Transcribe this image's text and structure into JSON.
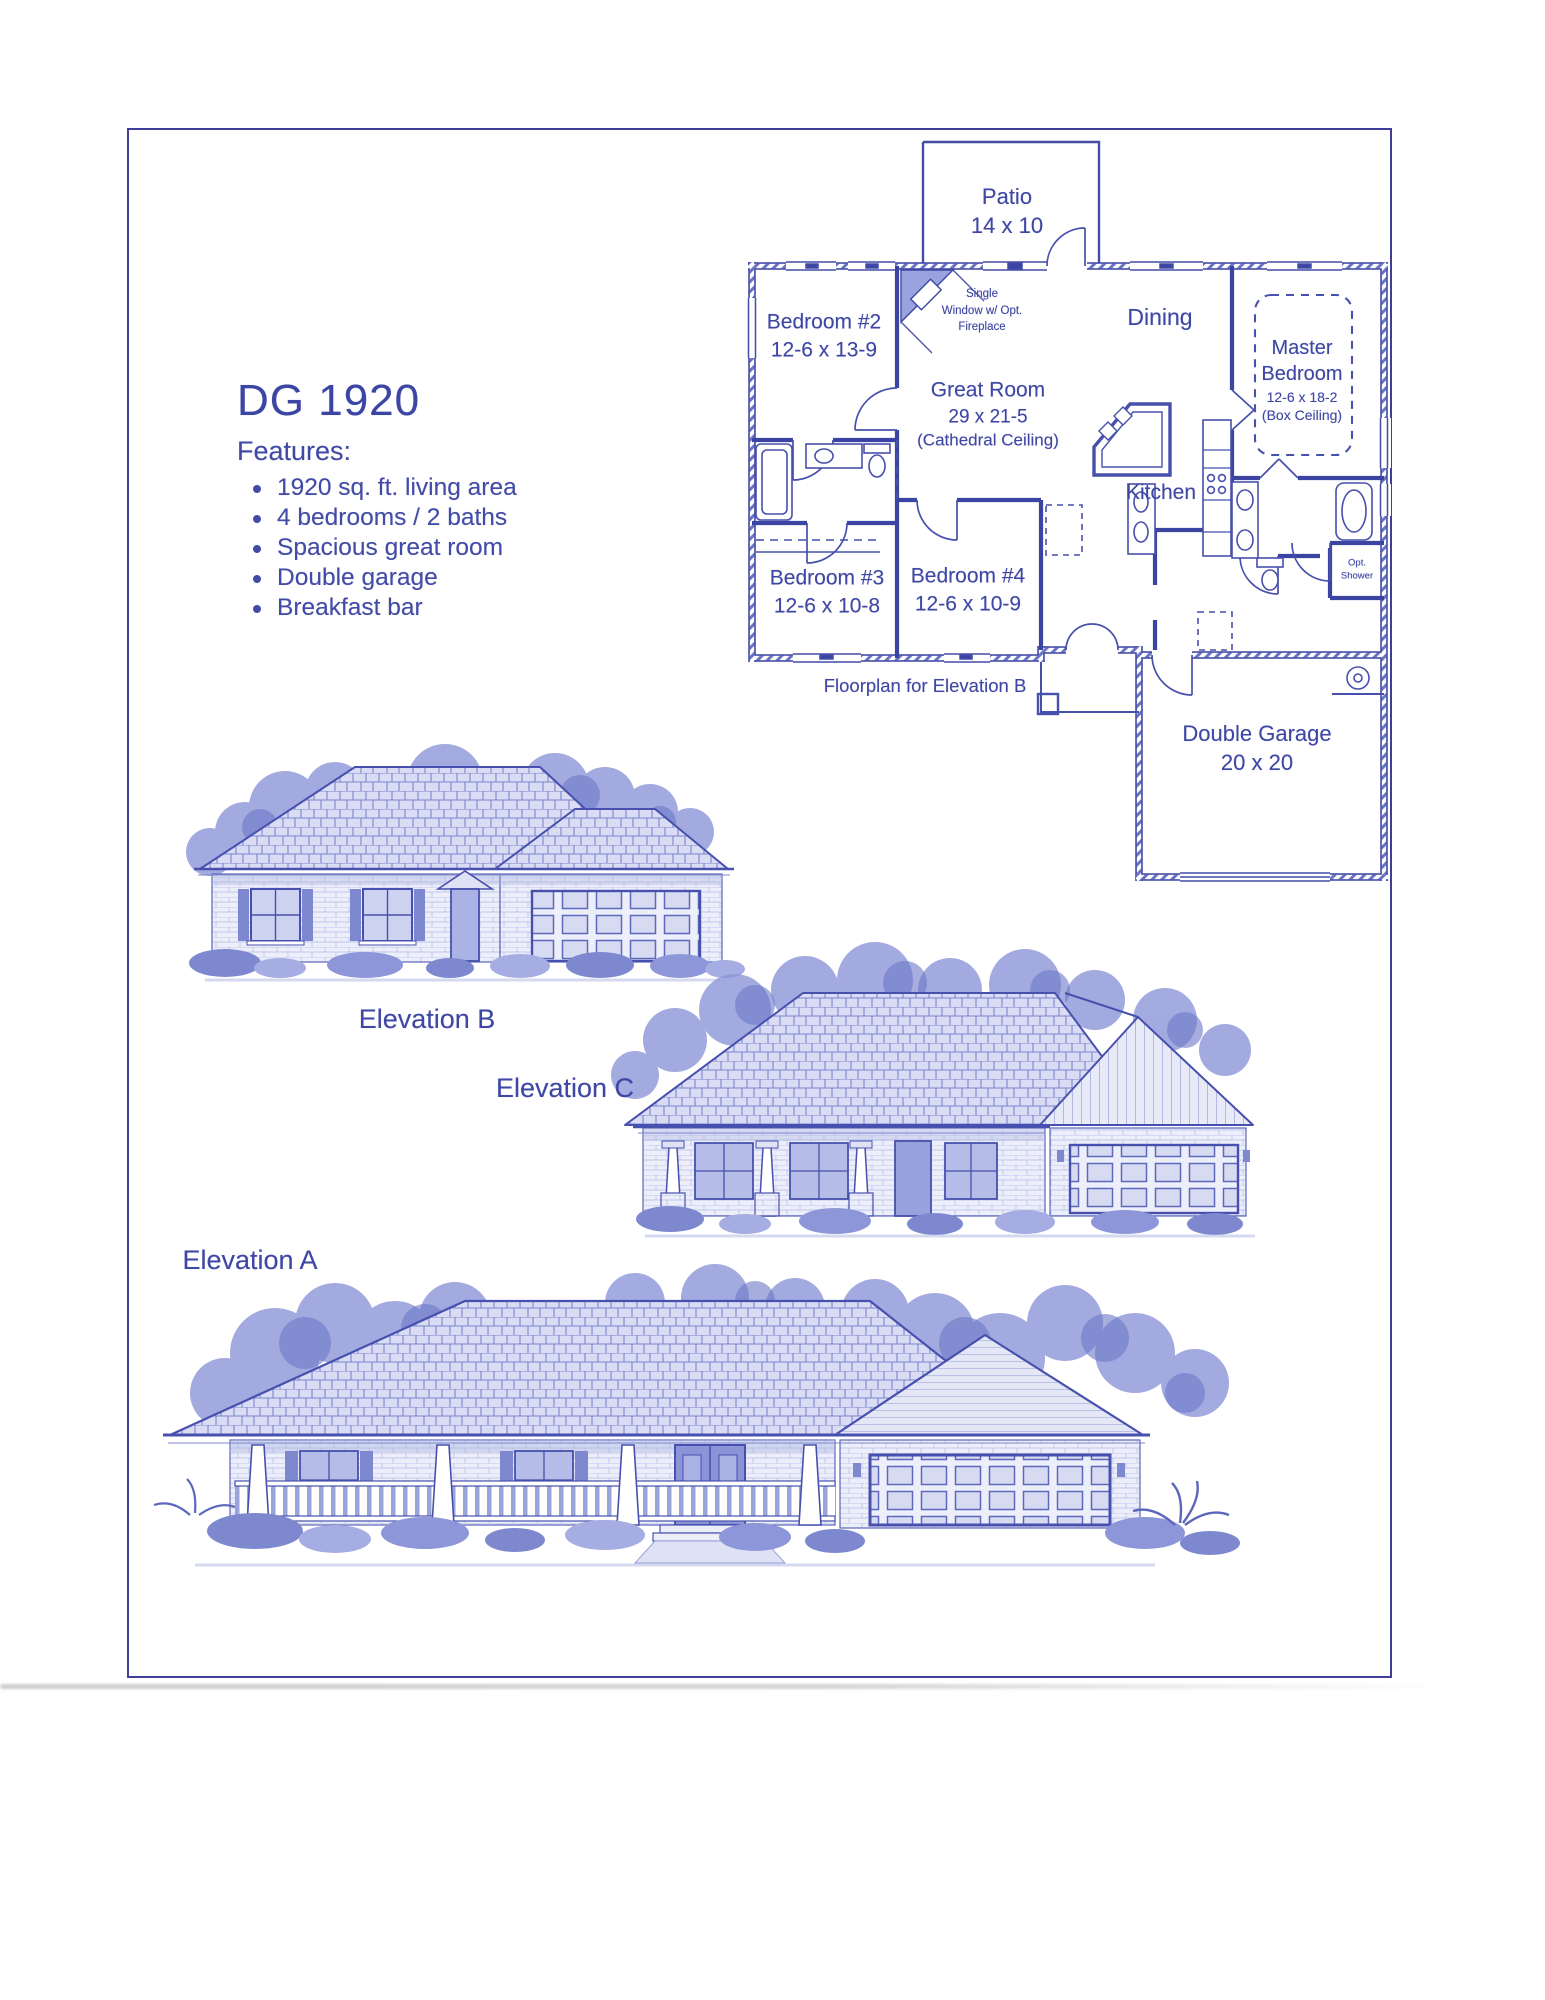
{
  "document": {
    "plan_id": "DG 1920",
    "features_heading": "Features:",
    "features": [
      "1920 sq. ft. living area",
      "4 bedrooms / 2 baths",
      "Spacious great room",
      "Double garage",
      "Breakfast bar"
    ],
    "floorplan_caption": "Floorplan for Elevation B"
  },
  "floorplan": {
    "patio": {
      "name": "Patio",
      "dims": "14 x 10"
    },
    "bedroom2": {
      "name": "Bedroom #2",
      "dims": "12-6 x 13-9"
    },
    "fireplace_note": {
      "line1": "Single",
      "line2": "Window w/ Opt.",
      "line3": "Fireplace"
    },
    "dining": {
      "name": "Dining"
    },
    "master": {
      "line1": "Master",
      "line2": "Bedroom",
      "dims": "12-6 x 18-2",
      "note": "(Box Ceiling)"
    },
    "great_room": {
      "name": "Great Room",
      "dims": "29 x 21-5",
      "note": "(Cathedral Ceiling)"
    },
    "kitchen": {
      "name": "Kitchen"
    },
    "bedroom3": {
      "name": "Bedroom #3",
      "dims": "12-6 x 10-8"
    },
    "bedroom4": {
      "name": "Bedroom #4",
      "dims": "12-6 x 10-9"
    },
    "opt_shower": {
      "line1": "Opt.",
      "line2": "Shower"
    },
    "garage": {
      "name": "Double Garage",
      "dims": "20 x 20"
    }
  },
  "elevations": {
    "b": "Elevation B",
    "c": "Elevation C",
    "a": "Elevation A"
  },
  "colors": {
    "ink_blue": "#3c44a3",
    "light_wash": "#aab2e0"
  }
}
